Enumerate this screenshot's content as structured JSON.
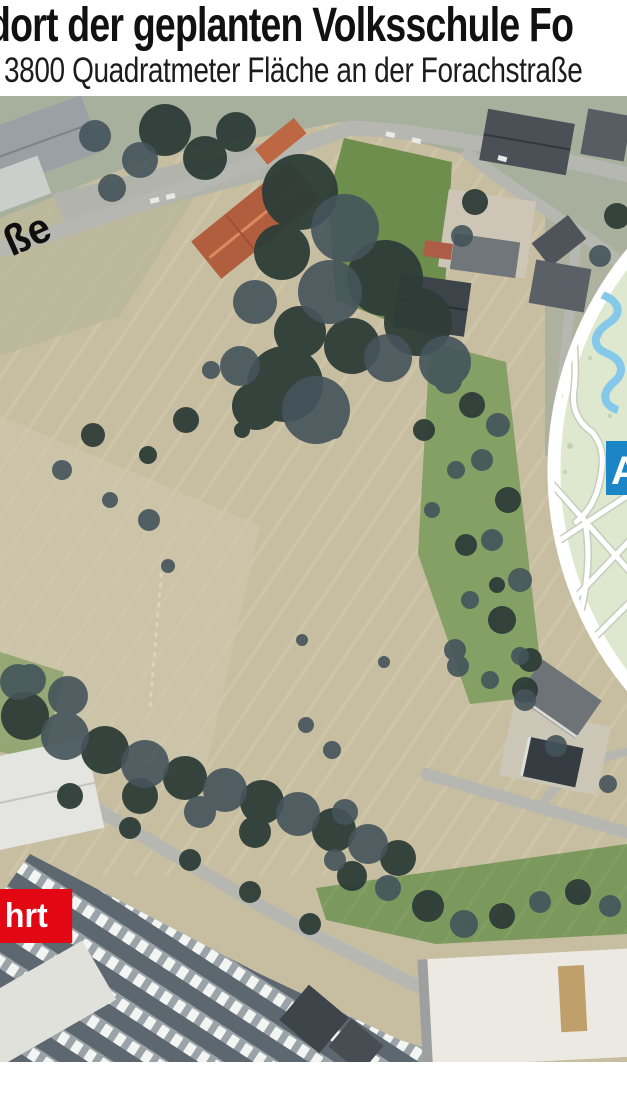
{
  "header": {
    "title": "dort der geplanten Volksschule Fo",
    "subtitle": "3800 Quadratmeter Fläche an der Forachstraße"
  },
  "aerial": {
    "street_label": "ße",
    "access_badge": "hrt",
    "inset": {
      "label": "A"
    }
  },
  "colors": {
    "badge_red": "#e30613",
    "inset_label_blue": "#1b85c6",
    "inset_map_green": "#dde8cf",
    "river_blue": "#84c8ea",
    "field_tan": "#c7bea2",
    "headline_black": "#111111"
  }
}
